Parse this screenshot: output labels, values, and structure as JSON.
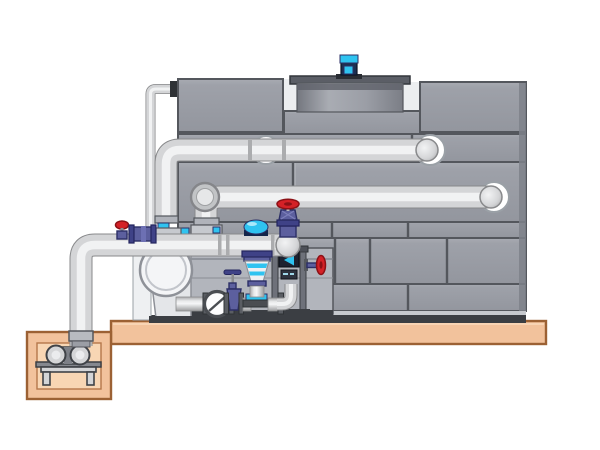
{
  "scene": {
    "kind": "technical-illustration",
    "subject": "cooling-tower-with-pump-skid-and-sump-side-elevation",
    "canvas": {
      "width": 600,
      "height": 450
    },
    "visible_text": []
  },
  "colors": {
    "bg": "#ffffff",
    "panel": "#9b9ea6",
    "panelEdge": "#54575d",
    "sideFace": "#7e818a",
    "baseDark": "#3b3e43",
    "pipeBody": "#d4d5d7",
    "pipeHighlight": "#f1f2f3",
    "pipeOutline": "#88898b",
    "concrete": "#f2c29c",
    "concreteInner": "#f8d6b4",
    "concreteEdge": "#9c6134",
    "cyan": "#2fc3f0",
    "navy": "#5c5f9e",
    "navyDark": "#2c2f66",
    "motorNavy": "#1c2f52",
    "red": "#d42127",
    "redDark": "#8c1116",
    "steelBackdrop": "#b2b5bc"
  },
  "components": {
    "cooling_tower": {
      "panel_rows": 6,
      "fan_shroud": true,
      "fan_motor_color_key": "cyan"
    },
    "pipes": [
      {
        "name": "upper-return-pipe",
        "enters_tower_through_ring": true
      },
      {
        "name": "middle-return-pipe",
        "enters_tower_through_ring": true
      },
      {
        "name": "suction-header-pipe",
        "end": "domed-cap",
        "routes_to": "sump-pit"
      },
      {
        "name": "makeup-water-pipe",
        "size": "small-bore"
      }
    ],
    "valves": [
      {
        "name": "top-gate-valve",
        "handwheel_color_key": "red"
      },
      {
        "name": "column-side-valve",
        "handwheel_color_key": "red"
      },
      {
        "name": "header-mini-valve",
        "handwheel_color_key": "red"
      },
      {
        "name": "manifold-gate-valve",
        "handle": "tee"
      },
      {
        "name": "check-valve-disc",
        "shape": "circle-with-diagonal"
      }
    ],
    "pump_skid": {
      "circulation_pump_volute": true,
      "control_cone_color_key": "cyan",
      "blue_dome_cap": true,
      "gauge_chevron_color_key": "cyan",
      "manifold_flanges": 6
    },
    "sump": {
      "pit_color_key": "concrete",
      "pump_on_stand": true
    }
  }
}
